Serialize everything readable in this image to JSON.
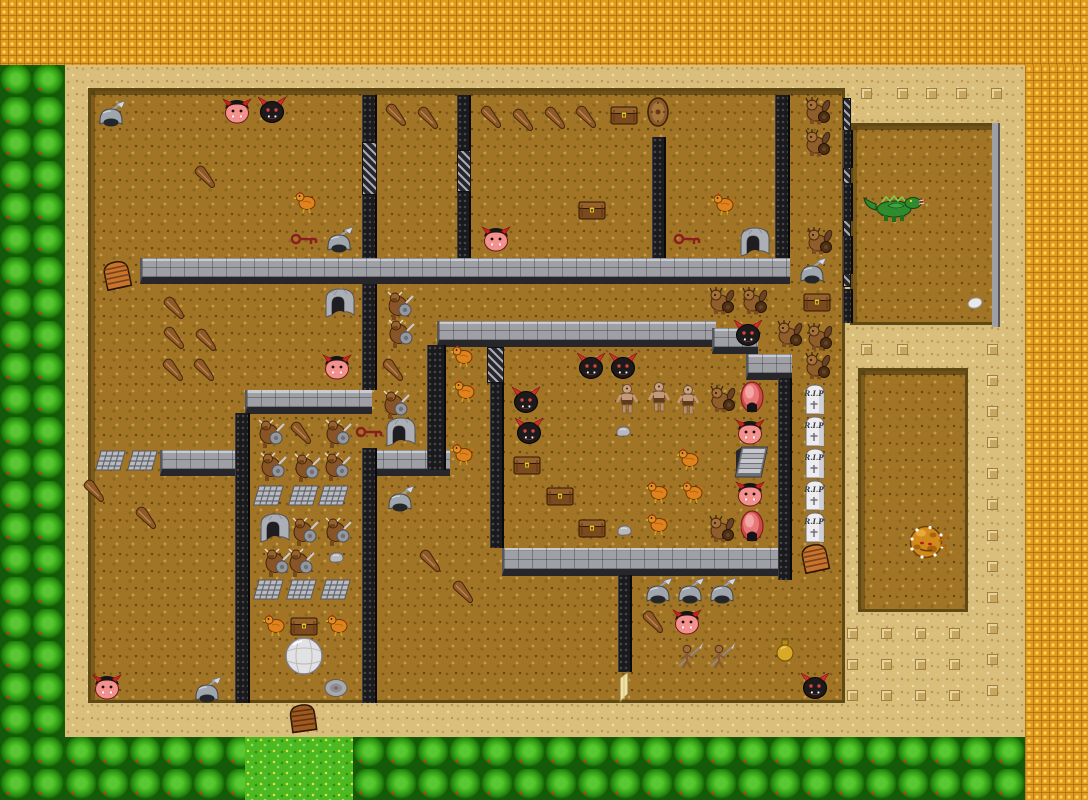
{
  "labels": {
    "tombstone": "R.I.P"
  },
  "palette": {
    "void_orange": "#E09A1E",
    "sand": "#D9BE7C",
    "dirt": "#A27526",
    "bush_green": "#2F9E14",
    "grass_green": "#4CB822",
    "wall_gray": "#9EA0A6",
    "wall_dark": "#1A1A1C",
    "demon_red": "#F2918E",
    "demon_black": "#1B1B1B",
    "portal_pink": "#E87878",
    "dragon_green": "#2E8B2E",
    "blob_orange": "#D28A1A",
    "key_red": "#8B1F1F"
  },
  "terrain": {
    "sand": [
      [
        65,
        65,
        960,
        672
      ]
    ],
    "orange": [
      [
        0,
        0,
        1088,
        65
      ],
      [
        1025,
        65,
        63,
        735
      ]
    ],
    "bush": [
      [
        0,
        65,
        65,
        735
      ],
      [
        65,
        737,
        180,
        63
      ],
      [
        353,
        737,
        672,
        63
      ]
    ],
    "grass": [
      [
        245,
        737,
        108,
        63
      ]
    ],
    "dirt": [
      [
        88,
        88,
        757,
        615
      ],
      [
        850,
        123,
        150,
        202
      ],
      [
        858,
        368,
        110,
        244
      ]
    ]
  },
  "walls": {
    "horizontal": [
      [
        140,
        258,
        650,
        26
      ],
      [
        437,
        321,
        279,
        26
      ],
      [
        712,
        328,
        46,
        26
      ],
      [
        746,
        354,
        46,
        26
      ],
      [
        245,
        390,
        127,
        24
      ],
      [
        160,
        450,
        77,
        26
      ],
      [
        367,
        450,
        83,
        26
      ],
      [
        502,
        548,
        288,
        28
      ]
    ],
    "vertical": [
      [
        362,
        95,
        15,
        47
      ],
      [
        362,
        195,
        15,
        63
      ],
      [
        457,
        95,
        14,
        55
      ],
      [
        457,
        192,
        14,
        66
      ],
      [
        652,
        137,
        14,
        121
      ],
      [
        775,
        95,
        15,
        163
      ],
      [
        362,
        284,
        15,
        106
      ],
      [
        427,
        345,
        19,
        125
      ],
      [
        490,
        383,
        14,
        165
      ],
      [
        618,
        575,
        14,
        97
      ],
      [
        235,
        413,
        15,
        290
      ],
      [
        362,
        448,
        15,
        255
      ],
      [
        778,
        378,
        14,
        202
      ]
    ],
    "grates": [
      [
        362,
        142,
        15,
        53
      ],
      [
        457,
        150,
        14,
        42
      ],
      [
        487,
        347,
        17,
        36
      ]
    ],
    "edge_hatch": [
      [
        843,
        98,
        8,
        40
      ],
      [
        843,
        150,
        8,
        40
      ],
      [
        843,
        200,
        8,
        40
      ],
      [
        843,
        253,
        8,
        34
      ],
      [
        843,
        291,
        8,
        30
      ]
    ],
    "room_black": [
      [
        843,
        130,
        10,
        38
      ],
      [
        843,
        183,
        10,
        38
      ],
      [
        843,
        236,
        10,
        38
      ],
      [
        843,
        289,
        10,
        34
      ]
    ],
    "room_thin": [
      [
        992,
        123,
        8,
        204
      ]
    ]
  },
  "decor": {
    "sand_marks": [
      [
        866,
        93
      ],
      [
        902,
        93
      ],
      [
        931,
        93
      ],
      [
        961,
        93
      ],
      [
        996,
        93
      ],
      [
        866,
        349
      ],
      [
        902,
        349
      ],
      [
        992,
        349
      ],
      [
        992,
        380
      ],
      [
        992,
        411
      ],
      [
        992,
        442
      ],
      [
        992,
        473
      ],
      [
        992,
        504
      ],
      [
        992,
        535
      ],
      [
        992,
        566
      ],
      [
        992,
        597
      ],
      [
        992,
        628
      ],
      [
        992,
        659
      ],
      [
        992,
        690
      ],
      [
        852,
        633
      ],
      [
        886,
        633
      ],
      [
        920,
        633
      ],
      [
        954,
        633
      ],
      [
        852,
        664
      ],
      [
        886,
        664
      ],
      [
        920,
        664
      ],
      [
        954,
        664
      ],
      [
        852,
        695
      ],
      [
        886,
        695
      ],
      [
        920,
        695
      ],
      [
        954,
        695
      ]
    ]
  },
  "entities": [
    {
      "type": "red-demon-face",
      "positions": [
        [
          237,
          111
        ],
        [
          496,
          239
        ],
        [
          337,
          367
        ],
        [
          750,
          432
        ],
        [
          750,
          494
        ],
        [
          687,
          622
        ],
        [
          107,
          687
        ]
      ]
    },
    {
      "type": "black-demon-face",
      "positions": [
        [
          272,
          110
        ],
        [
          591,
          366
        ],
        [
          623,
          366
        ],
        [
          526,
          400
        ],
        [
          529,
          431
        ],
        [
          748,
          333
        ],
        [
          815,
          686
        ]
      ]
    },
    {
      "type": "troll",
      "positions": [
        [
          818,
          110
        ],
        [
          818,
          142
        ],
        [
          820,
          240
        ],
        [
          722,
          300
        ],
        [
          755,
          300
        ],
        [
          790,
          333
        ],
        [
          820,
          336
        ],
        [
          818,
          365
        ],
        [
          723,
          398
        ],
        [
          722,
          528
        ]
      ]
    },
    {
      "type": "minotaur",
      "positions": [
        [
          399,
          305
        ],
        [
          400,
          333
        ],
        [
          395,
          404
        ],
        [
          270,
          433
        ],
        [
          337,
          433
        ],
        [
          272,
          466
        ],
        [
          306,
          467
        ],
        [
          336,
          466
        ],
        [
          304,
          531
        ],
        [
          337,
          531
        ],
        [
          276,
          562
        ],
        [
          300,
          562
        ]
      ]
    },
    {
      "type": "cyclops",
      "positions": [
        [
          627,
          399
        ],
        [
          659,
          397
        ],
        [
          688,
          400
        ]
      ]
    },
    {
      "type": "spearman",
      "positions": [
        [
          690,
          655
        ],
        [
          722,
          655
        ]
      ]
    },
    {
      "type": "dragon",
      "positions": [
        [
          895,
          207
        ]
      ]
    },
    {
      "type": "blob-monster",
      "positions": [
        [
          926,
          542
        ]
      ]
    },
    {
      "type": "chicken",
      "positions": [
        [
          306,
          201
        ],
        [
          724,
          203
        ],
        [
          463,
          355
        ],
        [
          465,
          390
        ],
        [
          463,
          453
        ],
        [
          689,
          458
        ],
        [
          658,
          491
        ],
        [
          693,
          491
        ],
        [
          658,
          523
        ],
        [
          275,
          624
        ],
        [
          338,
          624
        ]
      ]
    },
    {
      "type": "club",
      "positions": [
        [
          207,
          177
        ],
        [
          398,
          115
        ],
        [
          430,
          118
        ],
        [
          493,
          117
        ],
        [
          525,
          120
        ],
        [
          557,
          118
        ],
        [
          588,
          117
        ],
        [
          176,
          308
        ],
        [
          176,
          338
        ],
        [
          208,
          340
        ],
        [
          175,
          370
        ],
        [
          206,
          370
        ],
        [
          395,
          370
        ],
        [
          303,
          433
        ],
        [
          96,
          491
        ],
        [
          148,
          518
        ],
        [
          432,
          561
        ],
        [
          465,
          592
        ],
        [
          655,
          622
        ]
      ]
    },
    {
      "type": "chest",
      "positions": [
        [
          624,
          113
        ],
        [
          592,
          208
        ],
        [
          817,
          300
        ],
        [
          527,
          463
        ],
        [
          560,
          494
        ],
        [
          592,
          526
        ],
        [
          304,
          624
        ]
      ]
    },
    {
      "type": "key",
      "positions": [
        [
          304,
          239
        ],
        [
          687,
          239
        ],
        [
          369,
          432
        ]
      ]
    },
    {
      "type": "helmet-item",
      "positions": [
        [
          111,
          115
        ],
        [
          339,
          241
        ],
        [
          812,
          272
        ],
        [
          400,
          500
        ],
        [
          658,
          592
        ],
        [
          690,
          592
        ],
        [
          722,
          592
        ],
        [
          207,
          691
        ]
      ]
    },
    {
      "type": "wooden-shield",
      "positions": [
        [
          658,
          112
        ]
      ]
    },
    {
      "type": "stone-arch",
      "positions": [
        [
          755,
          241
        ],
        [
          340,
          302
        ],
        [
          401,
          431
        ],
        [
          275,
          527
        ]
      ]
    },
    {
      "type": "floor-grate",
      "positions": [
        [
          112,
          461
        ],
        [
          144,
          461
        ],
        [
          270,
          496
        ],
        [
          305,
          496
        ],
        [
          335,
          496
        ],
        [
          270,
          590
        ],
        [
          303,
          590
        ],
        [
          337,
          590
        ]
      ]
    },
    {
      "type": "tombstone",
      "positions": [
        [
          815,
          399
        ],
        [
          815,
          431
        ],
        [
          815,
          463
        ],
        [
          815,
          495
        ],
        [
          815,
          527
        ]
      ]
    },
    {
      "type": "portal",
      "positions": [
        [
          752,
          397
        ],
        [
          752,
          526
        ]
      ]
    },
    {
      "type": "stairs",
      "positions": [
        [
          751,
          462
        ]
      ]
    },
    {
      "type": "door-arch-orange",
      "positions": [
        [
          117,
          275
        ],
        [
          815,
          558
        ]
      ]
    },
    {
      "type": "door-arch-brown",
      "positions": [
        [
          303,
          718
        ]
      ]
    },
    {
      "type": "door-open-yellow",
      "positions": [
        [
          624,
          687
        ]
      ]
    },
    {
      "type": "boulder-sphere",
      "positions": [
        [
          304,
          656
        ]
      ]
    },
    {
      "type": "stone-disc",
      "positions": [
        [
          336,
          688
        ]
      ]
    },
    {
      "type": "stone-small",
      "positions": [
        [
          623,
          431
        ],
        [
          624,
          530
        ],
        [
          336,
          557
        ]
      ]
    },
    {
      "type": "stone-egg",
      "positions": [
        [
          975,
          303
        ]
      ]
    },
    {
      "type": "flask",
      "positions": [
        [
          785,
          650
        ]
      ]
    }
  ]
}
